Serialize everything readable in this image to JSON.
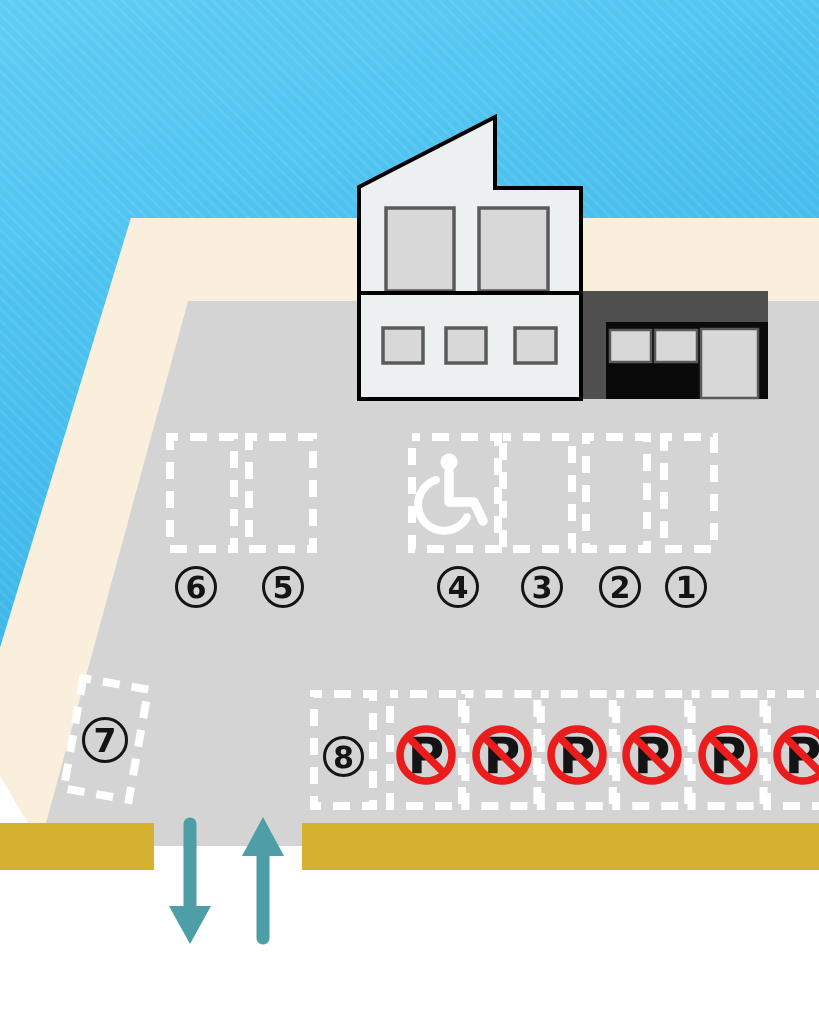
{
  "scene": {
    "kind": "parking-lot-illustration"
  },
  "colors": {
    "sky_top": "#5ECDF5",
    "sky_bottom": "#38B4E8",
    "sand": "#FAEEDC",
    "lot": "#D4D4D5",
    "road": "#D4B22F",
    "marking_white": "#FFFFFF",
    "ink": "#141414",
    "no_parking_red": "#EA1C1C",
    "arrow_teal": "#4D9EA6",
    "building_wall": "#EDF0F1",
    "building_dark": "#4F4F4F",
    "storefront_black": "#0A0A0A",
    "window_fill": "#D8D8D9",
    "window_border": "#5A5A5A",
    "outline_black": "#000000"
  },
  "spaces": {
    "labels": [
      "1",
      "2",
      "3",
      "4",
      "5",
      "6",
      "7",
      "8"
    ],
    "count": 8,
    "accessible_space_label": "4"
  },
  "no_parking": {
    "symbol": "P",
    "count": 6
  },
  "icons": {
    "accessible": "wheelchair-icon",
    "forbidden": "no-parking-icon",
    "entry": "up-arrow-icon",
    "exit": "down-arrow-icon"
  }
}
